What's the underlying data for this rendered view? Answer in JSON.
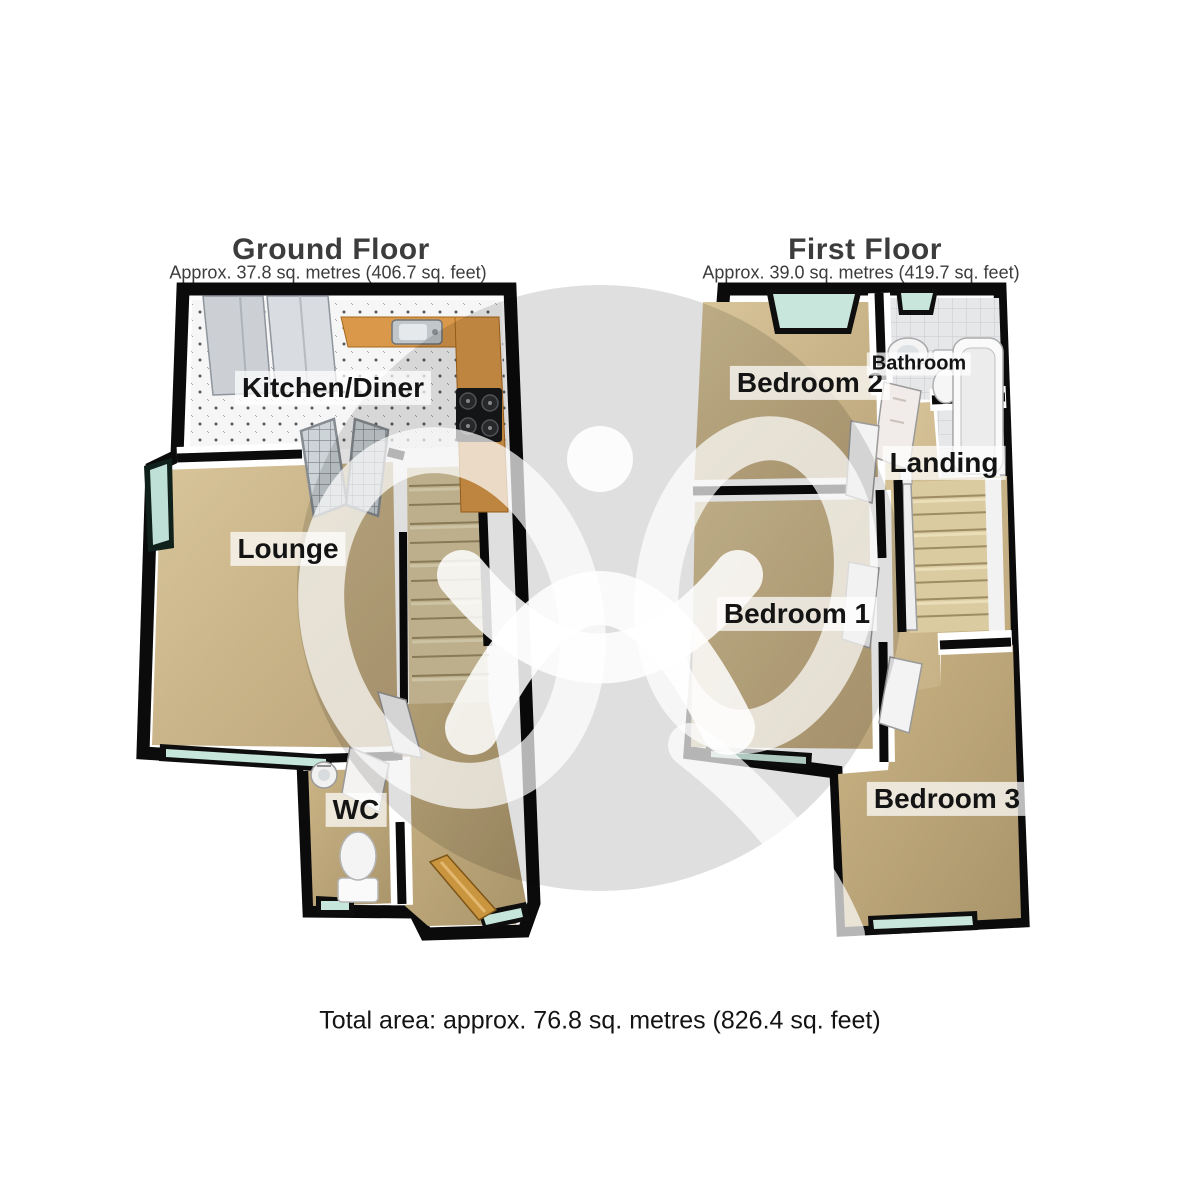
{
  "document": {
    "type": "3d-floorplan",
    "footer": {
      "total_area": "Total area: approx. 76.8 sq. metres (826.4 sq. feet)"
    }
  },
  "ground_floor": {
    "title": "Ground Floor",
    "subtitle": "Approx. 37.8 sq. metres (406.7 sq. feet)",
    "rooms": {
      "kitchen": "Kitchen/Diner",
      "lounge": "Lounge",
      "wc": "WC"
    }
  },
  "first_floor": {
    "title": "First Floor",
    "subtitle": "Approx. 39.0 sq. metres (419.7 sq. feet)",
    "rooms": {
      "bedroom2": "Bedroom 2",
      "bathroom": "Bathroom",
      "landing": "Landing",
      "bedroom1": "Bedroom 1",
      "bedroom3": "Bedroom 3"
    }
  },
  "colors": {
    "wall": "#0b0b0b",
    "carpet": "#cdb98c",
    "kitchen_counter": "#d9984a",
    "window_glass": "#c6e6dc",
    "stairs": "#dbcba1",
    "watermark_grey": "#dcdcdc",
    "label_text": "#141414"
  }
}
